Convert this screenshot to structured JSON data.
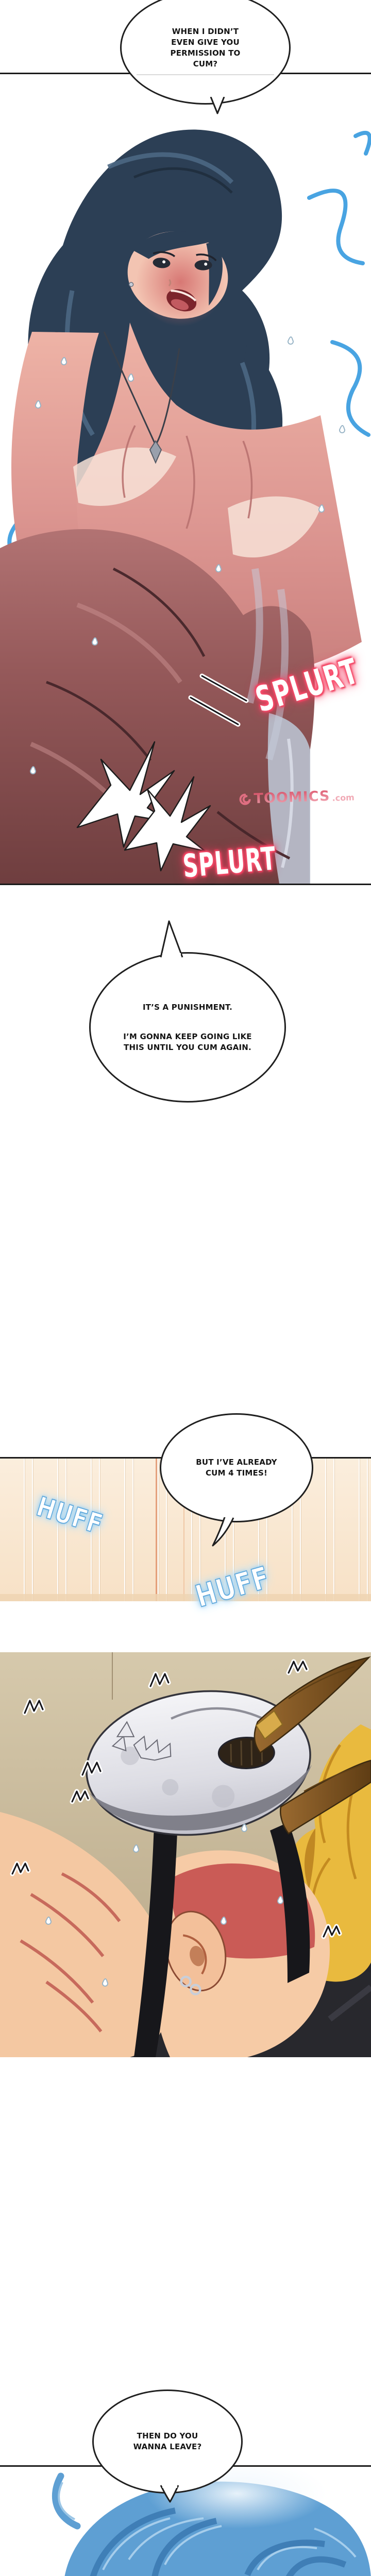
{
  "palette": {
    "panel_border": "#1b1b1b",
    "splurt_glow_red": "#f43b5f",
    "huff_blue": "#5fa8dc",
    "wall_beige": "#f8e3c9",
    "wall_accent_orange": "#de8f66",
    "hair_navy": "#2c3f55",
    "hair_blue_accent": "#3f9fe0",
    "skin_pink_flush": "#d48a86",
    "closeup_maroon": "#8a4f4d",
    "blonde_hair": "#e9ba3e",
    "skull_mask_gray": "#e8e8ee",
    "horn_brown": "#8a5c26",
    "bedding_dark": "#28282d",
    "bottom_hair_blue": "#5e9fd3",
    "watermark_pink": "#f0a3b0"
  },
  "bubble1": {
    "line1": "WHEN I DIDN’T",
    "line2": "EVEN GIVE YOU",
    "line3": "PERMISSION TO",
    "line4": "CUM?"
  },
  "bubble2": {
    "line1": "IT’S A PUNISHMENT.",
    "line2": "I’M GONNA KEEP GOING LIKE",
    "line3": "THIS UNTIL YOU CUM AGAIN."
  },
  "bubble3": {
    "line1": "BUT I’VE ALREADY",
    "line2": "CUM 4 TIMES!"
  },
  "bubble4": {
    "line1": "THEN DO YOU",
    "line2": "WANNA LEAVE?"
  },
  "sfx": {
    "splurt1": "SPLURT",
    "splurt2": "SPLURT",
    "huff1": "HUFF",
    "huff2": "HUFF"
  },
  "watermark": {
    "brand": "TOOMICS",
    "suffix": ".com"
  }
}
